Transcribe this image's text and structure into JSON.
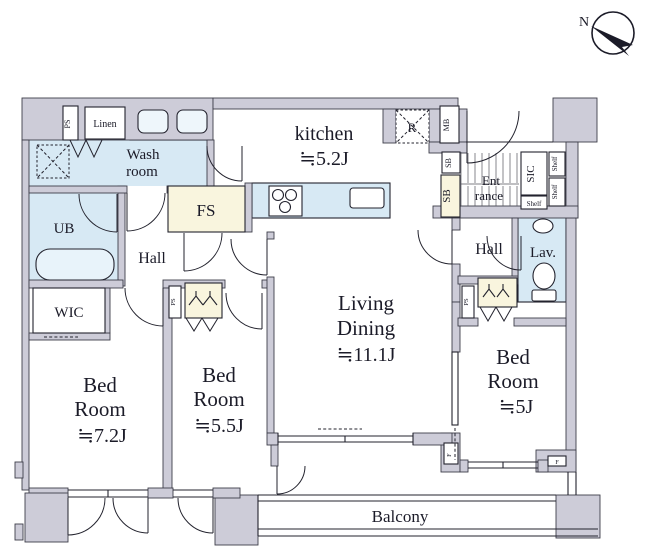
{
  "title": "apartment-floor-plan",
  "compass": {
    "north_label": "N"
  },
  "colors": {
    "wall": "#cdccd8",
    "wet_area_blue": "#d7e9f4",
    "storage_cream": "#f9f5de",
    "line": "#23232e",
    "background": "#ffffff"
  },
  "rooms": {
    "kitchen": {
      "name": "kitchen",
      "size": "≒5.2J"
    },
    "living": {
      "line1": "Living",
      "line2": "Dining",
      "size": "≒11.1J"
    },
    "bed1": {
      "line1": "Bed",
      "line2": "Room",
      "size": "≒7.2J"
    },
    "bed2": {
      "line1": "Bed",
      "line2": "Room",
      "size": "≒5.5J"
    },
    "bed3": {
      "line1": "Bed",
      "line2": "Room",
      "size": "≒5J"
    },
    "washroom": {
      "line1": "Wash",
      "line2": "room"
    },
    "hall_left": {
      "name": "Hall"
    },
    "hall_right": {
      "name": "Hall"
    },
    "entrance": {
      "line1": "Ent",
      "line2": "rance"
    },
    "ub": {
      "name": "UB"
    },
    "wic": {
      "name": "WIC"
    },
    "fs": {
      "name": "FS"
    },
    "linen": {
      "name": "Linen"
    },
    "sic": {
      "name": "SIC"
    },
    "lav": {
      "name": "Lav."
    },
    "balcony": {
      "name": "Balcony"
    }
  },
  "labels": {
    "ps1": "PS",
    "ps2": "PS",
    "ps3": "PS",
    "r": "R",
    "mb": "MB",
    "sb_small": "SB",
    "sb_large": "SB",
    "shelf1": "Shelf",
    "shelf2": "Shelf",
    "shelf3": "Shelf",
    "f1": "F",
    "f2": "F"
  }
}
